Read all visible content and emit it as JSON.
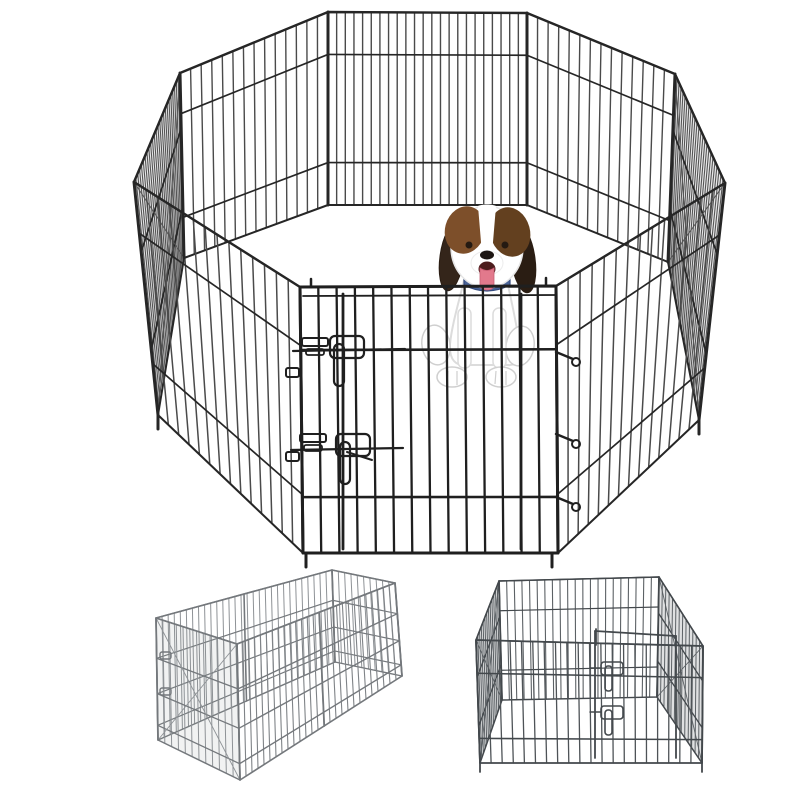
{
  "page": {
    "background": "#ffffff",
    "alt": "Product photo of an 8-panel black wire pet exercise playpen arranged as an octagon with a beagle puppy sitting inside, plus two smaller images below showing the pen folded into a rectangle and a square configuration with a latched door"
  },
  "views": {
    "main": {
      "label": "octagon-playpen-with-puppy",
      "panel_count": 8,
      "gate_latch_count": 2,
      "gate_hinge_count": 3
    },
    "bottom_left": {
      "label": "rectangle-configuration"
    },
    "bottom_right": {
      "label": "square-configuration-with-door",
      "latch_count": 2
    }
  },
  "colors": {
    "bg": "#ffffff",
    "wireFrame": "#262626",
    "wireMid": "#4a4a4a",
    "wireGate": "#1f1f1f",
    "sideShade": "rgba(125,128,131,0.18)",
    "thumb1Wire": "#8e9296",
    "thumb1Frame": "#74787c",
    "thumb1Shade": "rgba(140,144,148,0.12)",
    "thumb2Wire": "#5c6165",
    "thumb2Frame": "#43484c",
    "thumb2Shade": "rgba(110,114,118,0.22)",
    "dogWhite": "#ffffff",
    "dogOutline": "#dcdcdc",
    "dogShade": "#cfcfcf",
    "earDark": "#34251a",
    "earDarker": "#2a1d13",
    "brown": "#7d4f2a",
    "brownDark": "#63401f",
    "eye": "#241a12",
    "nose": "#1c1512",
    "mouth": "#4d1d1d",
    "tongue": "#e2798c",
    "tongueDark": "#c95f74",
    "collar": "#4a6396",
    "collarDark": "#32497e"
  }
}
